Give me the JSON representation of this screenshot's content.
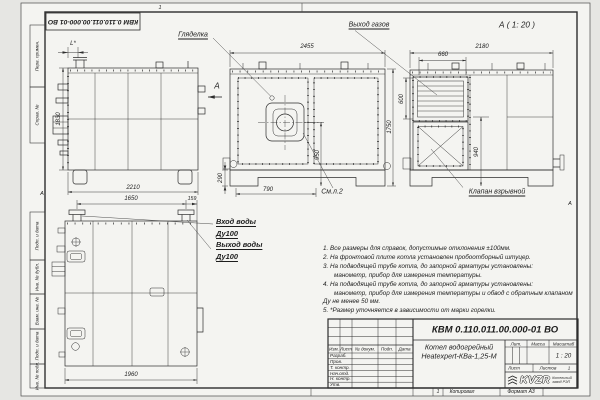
{
  "frame": {
    "stamp": "КВМ 0.110.011.00.000-01 ВО",
    "zone_top": "1",
    "zone_left": "А",
    "zone_right": "А",
    "margin_top": [
      "Перв. примен.",
      "Справ. №"
    ],
    "margin_bottom": [
      "Подп. и дата",
      "Инв. № дубл.",
      "Взам. инв. №",
      "Подп. и дата",
      "Инв. № подл."
    ],
    "footer": {
      "zone": "1",
      "copied": "Копировал",
      "format": "Формат А3"
    }
  },
  "labels": {
    "peephole": "Гляделка",
    "gas_outlet": "Выход газов",
    "section_title": "А ( 1: 20 )",
    "section_arrow": "А",
    "explosion_valve": "Клапан взрывной",
    "see_sheet": "См.л.2",
    "water_in": "Вход воды",
    "water_in_dn": "Ду100",
    "water_out": "Выход воды",
    "water_out_dn": "Ду100"
  },
  "dims": {
    "side": {
      "w": "2210",
      "h": "1830",
      "l": "L*"
    },
    "front": {
      "w": "2455",
      "h": "1750",
      "axis": "950",
      "base": "290",
      "left": "790"
    },
    "section": {
      "w": "2180",
      "outlet_w": "660",
      "outlet_h": "600",
      "rear": "940"
    },
    "top": {
      "pitch": "1650",
      "edge": "159",
      "w": "1960"
    }
  },
  "notes": [
    "1. Все размеры для справок, допустимые отклонения ±100мм.",
    "2. На фронтовой плите котла установлен пробоотборный штуцер.",
    "3. На подводящей трубе котла, до запорной арматуры установлены:",
    "манометр, прибор для измерения температуры.",
    "4. На подводящей трубе котла, до запорной арматуры установлены:",
    "манометр, прибор для измерения температуры и обвод с обратным клапаном",
    "Ду не менее 50 мм.",
    "5. *Размер уточняется в зависимости от марки горелки."
  ],
  "title_block": {
    "designation": "КВМ 0.110.011.00.000-01 ВО",
    "product_line1": "Котел водогрейный",
    "product_line2": "Heatexpert-КВа-1,25-М",
    "cols": [
      "Изм.",
      "Лист",
      "№ докум.",
      "Подп.",
      "Дата"
    ],
    "rows": [
      "Разраб.",
      "Пров.",
      "Т. контр.",
      "Нач.отд.",
      "Н. контр.",
      "Утв."
    ],
    "lit": "Лит.",
    "mass": "Масса",
    "scale_label": "Масштаб",
    "scale": "1 : 20",
    "sheet_label": "Лист",
    "sheets_label": "Листов",
    "sheets": "1",
    "logo": "KVZR",
    "org_line1": "Котельный",
    "org_line2": "завод РЭП"
  }
}
